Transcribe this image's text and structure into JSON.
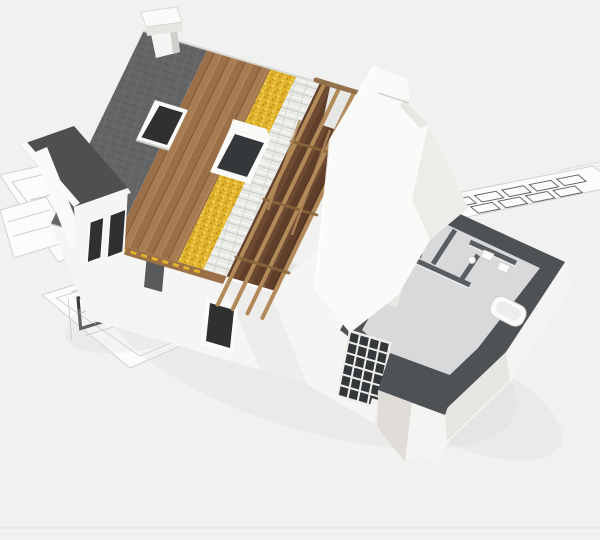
{
  "image": {
    "type": "3d-architectural-render",
    "subject": "cutaway house construction model standing on blueprint floor-plan sheets",
    "width": 600,
    "height": 540
  },
  "objects": [
    "chimney",
    "roof-tile-layer",
    "roof-wood-sheathing-layer",
    "roof-insulation-layer",
    "roof-batten-layer",
    "exposed-rafter-framing",
    "attic-floor",
    "skylight-window",
    "gable-end-wall",
    "front-wall",
    "front-window",
    "left-wing-dormer",
    "interior-cutaway-rooms",
    "cut-wall-tops",
    "kitchen-units",
    "bathroom-fixtures",
    "glazed-door-grid",
    "bathtub",
    "foundation-corner",
    "blueprint-sheets",
    "floor-plan-drawing"
  ],
  "colors": {
    "background": "#f1f1f0",
    "bottomLine": "#e6e6e4",
    "shadow": "#d9d9d6",
    "sheetWhite": "#fcfcfb",
    "sheetEdge": "#d2d2cf",
    "planLine": "#a6acb2",
    "planWall": "#3a3a3a",
    "wingRoof": "#4d4f51",
    "wallWhite": "#f5f5f3",
    "wallLight": "#fafaf8",
    "wallShade": "#e6e6e3",
    "wallDarkShade": "#cfcfcc",
    "windowGlass": "#2e3032",
    "windowFrame": "#fbfbfa",
    "glassDark": "#35383b",
    "gridBar": "#eeeeec",
    "tileBase": "#636567",
    "tileLine": "#54565a",
    "tileJoint": "#6e7072",
    "ridgeHighlight": "#d6d6d3",
    "woodA": "#a87c52",
    "woodB": "#9b7048",
    "woodLine": "#7c5a38",
    "woodHighlight": "#b68a5c",
    "insulBase": "#e0b32b",
    "insulDark": "#bd921c",
    "insulLight": "#f1d059",
    "battenBase": "#e9e9e6",
    "battenLine": "#c9c9c5",
    "battenHighlight": "#f6f6f4",
    "atticA": "#6d4a31",
    "atticB": "#5f3f29",
    "atticLine": "#49301f",
    "rafter": "#b28a5a",
    "rafterDark": "#8a653c",
    "cutWallTop": "#4f5255",
    "cutWallTop2": "#5a5e61",
    "interiorFloor": "#d8d9da",
    "interiorWall": "#ecedee",
    "foundationLight": "#f4f4f2",
    "foundationShade": "#e0ddd9",
    "doorShadow": "#3b3d3f"
  }
}
